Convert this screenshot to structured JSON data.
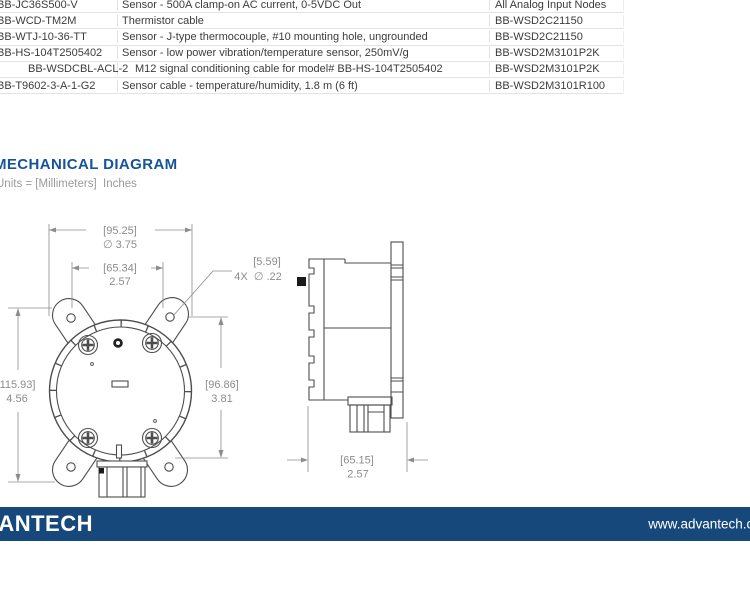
{
  "section": {
    "title": "MECHANICAL DIAGRAM",
    "units_note": "Units = [Millimeters]  Inches"
  },
  "table": {
    "rows": [
      {
        "part": "BB-JC36S500-V",
        "desc": "Sensor - 500A clamp-on AC current, 0-5VDC Out",
        "node": "All Analog Input Nodes"
      },
      {
        "part": "BB-WCD-TM2M",
        "desc": "Thermistor cable",
        "node": "BB-WSD2C21150"
      },
      {
        "part": "BB-WTJ-10-36-TT",
        "desc": "Sensor - J-type thermocouple, #10 mounting hole, ungrounded",
        "node": "BB-WSD2C21150"
      },
      {
        "part": "BB-HS-104T2505402",
        "desc": "Sensor - low power vibration/temperature sensor, 250mV/g",
        "node": "BB-WSD2M3101P2K"
      },
      {
        "part": "BB-WSDCBL-ACL-2",
        "desc": "M12 signal conditioning cable for model# BB-HS-104T2505402",
        "node": "BB-WSD2M3101P2K"
      },
      {
        "part": "BB-T9602-3-A-1-G2",
        "desc": "Sensor cable - temperature/humidity, 1.8 m (6 ft)",
        "node": "BB-WSD2M3101R100"
      }
    ]
  },
  "diagram": {
    "front": {
      "width_mm": "[95.25]",
      "width_in": "∅ 3.75",
      "holes_mm": "[65.34]",
      "holes_in": "2.57",
      "hole_dia_mm": "[5.59]",
      "hole_dia_in": "4X  ∅ .22",
      "height_mm": "[115.93]",
      "height_in": "4.56",
      "circle_mm": "[96.86]",
      "circle_in": "3.81"
    },
    "side": {
      "depth_mm": "[65.15]",
      "depth_in": "2.57"
    }
  },
  "footer": {
    "logo": "ADVANTECH",
    "url": "www.advantech.com"
  },
  "colors": {
    "accent_blue": "#15549b",
    "footer_blue": "#17487c",
    "drawing_line": "#4d4d4d",
    "dimension_gray": "#8c8c8c"
  }
}
